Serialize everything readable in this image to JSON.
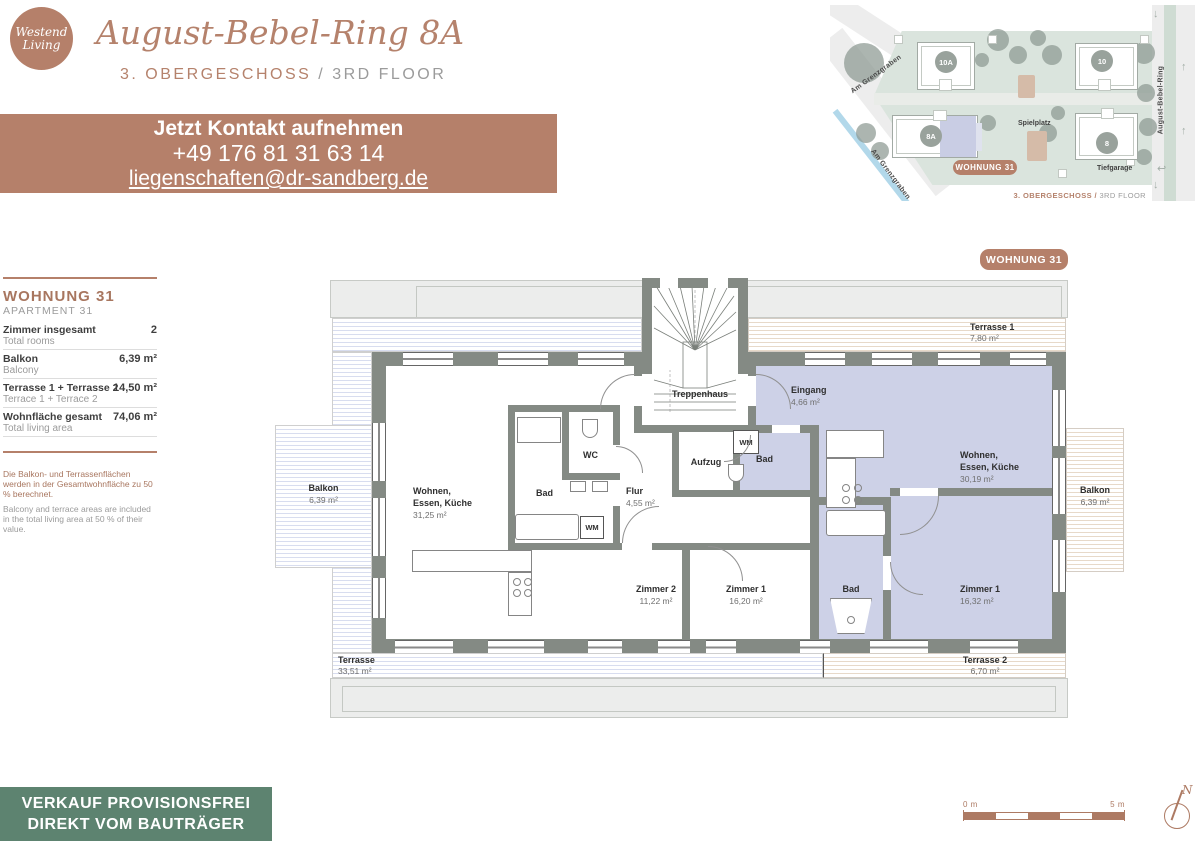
{
  "colors": {
    "accent": "#b5806a",
    "banner_green": "#5d8370",
    "apartment_highlight": "#cdd1e7",
    "wall": "#848a84",
    "map_green": "#dae4dd"
  },
  "header": {
    "logo_line1": "Westend",
    "logo_line2": "Living",
    "title": "August-Bebel-Ring 8A",
    "floor_de": "3. OBERGESCHOSS",
    "divider": "/",
    "floor_en": "3RD FLOOR"
  },
  "contact": {
    "heading": "Jetzt Kontakt aufnehmen",
    "phone": "+49 176 81 31 63 14",
    "email": "liegenschaften@dr-sandberg.de"
  },
  "icons": {
    "arrow_down": "↓",
    "arrow_up": "↑",
    "turn_arrow": "↩"
  },
  "sitemap": {
    "buildings": [
      {
        "id": "10A"
      },
      {
        "id": "10"
      },
      {
        "id": "8A"
      },
      {
        "id": "8"
      }
    ],
    "streets": {
      "grenzgraben_upper": "Am Grenzgraben",
      "grenzgraben_lower": "Am Grenzgraben",
      "august_bebel_ring": "August-Bebel-Ring"
    },
    "spielplatz": "Spielplatz",
    "tiefgarage": "Tiefgarage",
    "badge": "WOHNUNG 31",
    "caption_de": "3. OBERGESCHOSS /",
    "caption_en": "3RD FLOOR"
  },
  "info_panel": {
    "title_de": "WOHNUNG 31",
    "title_en": "APARTMENT 31",
    "rows": [
      {
        "label_de": "Zimmer insgesamt",
        "label_en": "Total rooms",
        "value": "2"
      },
      {
        "label_de": "Balkon",
        "label_en": "Balcony",
        "value": "6,39 m²"
      },
      {
        "label_de": "Terrasse 1 + Terrasse 2",
        "label_en": "Terrace 1 + Terrace 2",
        "value": "14,50 m²"
      },
      {
        "label_de": "Wohnfläche gesamt",
        "label_en": "Total living area",
        "value": "74,06 m²"
      }
    ],
    "note_de": "Die Balkon- und Terrassenflächen werden in der Gesamtwohnfläche zu 50 % berechnet.",
    "note_en": "Balcony and terrace areas are included in the total living area at 50 % of their value."
  },
  "floorplan": {
    "badge": "WOHNUNG 31",
    "rooms": {
      "terrasse1": {
        "name": "Terrasse 1",
        "area": "7,80 m²"
      },
      "treppenhaus": {
        "name": "Treppenhaus"
      },
      "aufzug": {
        "name": "Aufzug"
      },
      "eingang": {
        "name": "Eingang",
        "area": "4,66 m²"
      },
      "wm_right": {
        "name": "WM"
      },
      "bad_right_top": {
        "name": "Bad"
      },
      "wohnen_right": {
        "line1": "Wohnen,",
        "line2": "Essen, Küche",
        "area": "30,19 m²"
      },
      "balkon_left": {
        "name": "Balkon",
        "area": "6,39 m²"
      },
      "balkon_right": {
        "name": "Balkon",
        "area": "6,39 m²"
      },
      "wohnen_left": {
        "line1": "Wohnen,",
        "line2": "Essen, Küche",
        "area": "31,25 m²"
      },
      "bad_left": {
        "name": "Bad"
      },
      "wc_left": {
        "name": "WC"
      },
      "flur": {
        "name": "Flur",
        "area": "4,55 m²"
      },
      "wm_left": {
        "name": "WM"
      },
      "zimmer2_left": {
        "name": "Zimmer 2",
        "area": "11,22 m²"
      },
      "zimmer1_left": {
        "name": "Zimmer 1",
        "area": "16,20 m²"
      },
      "bad_right_bottom": {
        "name": "Bad"
      },
      "zimmer1_right": {
        "name": "Zimmer 1",
        "area": "16,32 m²"
      },
      "terrasse_main": {
        "name": "Terrasse",
        "area": "33,51 m²"
      },
      "terrasse2": {
        "name": "Terrasse 2",
        "area": "6,70 m²"
      }
    }
  },
  "footer": {
    "line1": "VERKAUF PROVISIONSFREI",
    "line2": "DIREKT VOM BAUTRÄGER"
  },
  "scalebar": {
    "start": "0 m",
    "end": "5 m"
  },
  "north_label": "N"
}
